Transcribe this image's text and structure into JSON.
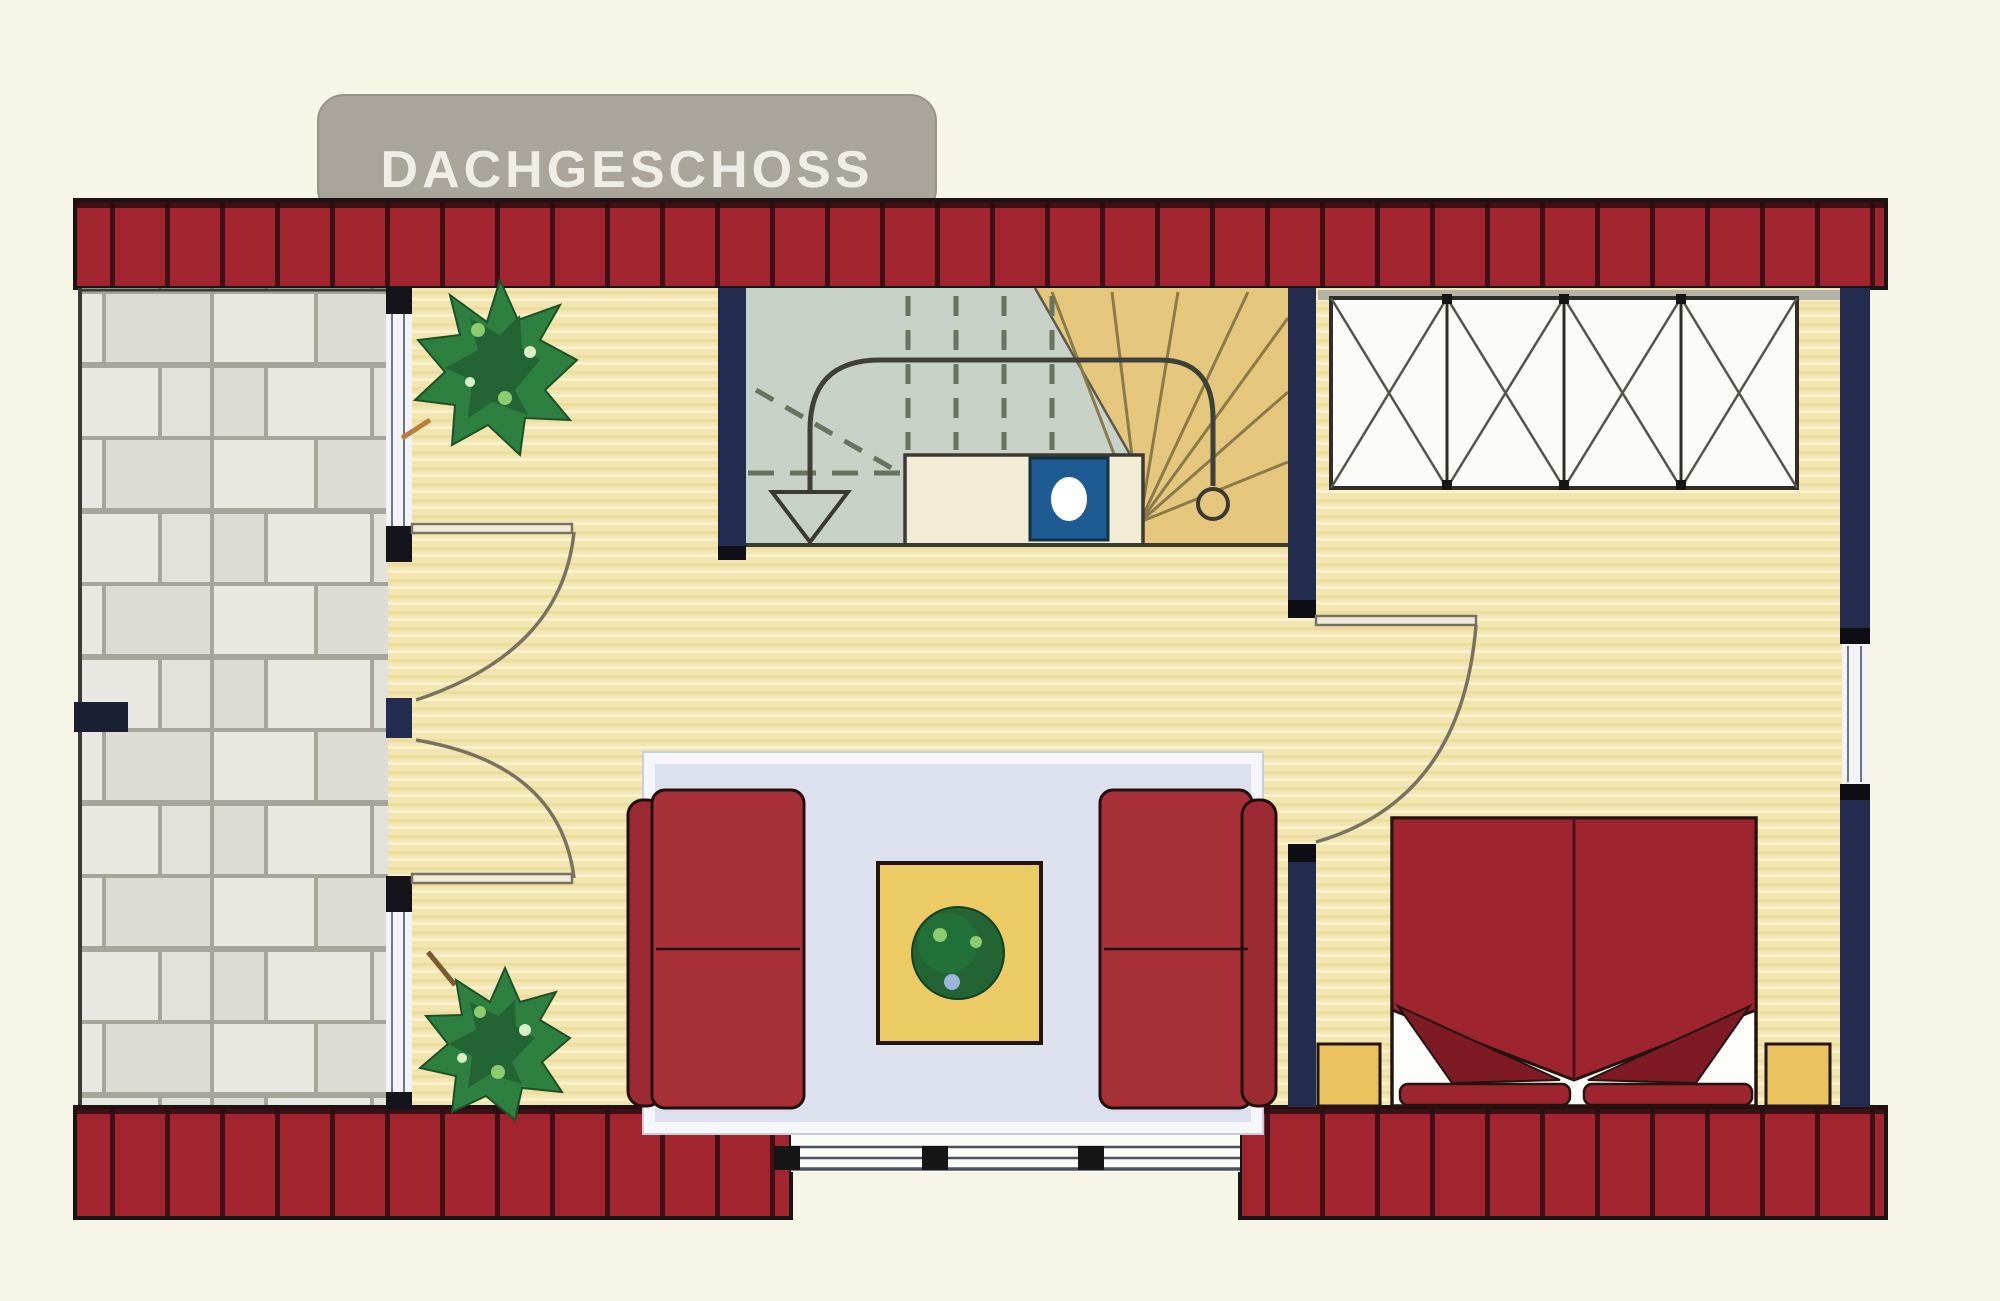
{
  "plan": {
    "title": "DACHGESCHOSS",
    "type": "floor-plan",
    "floor_label_language": "de"
  },
  "colors": {
    "bg": "#f6f5e6",
    "roof-red": "#a2242e",
    "roof-line": "#3f1016",
    "navy": "#232c4f",
    "ink": "#161616",
    "wood": "#f3e5b0",
    "wood-dark": "#e9d594",
    "wood-light": "#fbf2cb",
    "stone": "#e8e7e1",
    "stone-alt": "#dddcd4",
    "stone-c": "#e2e1da",
    "stone-joint": "#a7a49b",
    "stair-gray": "#c8d1c7",
    "stair-tan": "#e4c77d",
    "landing": "#f2ecd4",
    "chimney-blue": "#1d5b92",
    "sofa-red": "#9c2a33",
    "cushion-red": "#a83039",
    "bed-red": "#9e2430",
    "fold-red": "#7e1a23",
    "rug": "#dde1ee",
    "rug-border": "#f4f6fa",
    "table-yellow": "#eccb64",
    "nightstand-yellow": "#eac25e",
    "plant-green": "#2e8040",
    "plant-dark": "#236434",
    "plant-light": "#8ccb6e",
    "closet-white": "#fbfbf7",
    "line-dark": "#3a3a32",
    "door-line": "#7a7260",
    "glass": "#f2f3f5",
    "glass-line": "#6f7486",
    "tab-gray": "#a9a59a",
    "tab-text": "#efeee6"
  }
}
